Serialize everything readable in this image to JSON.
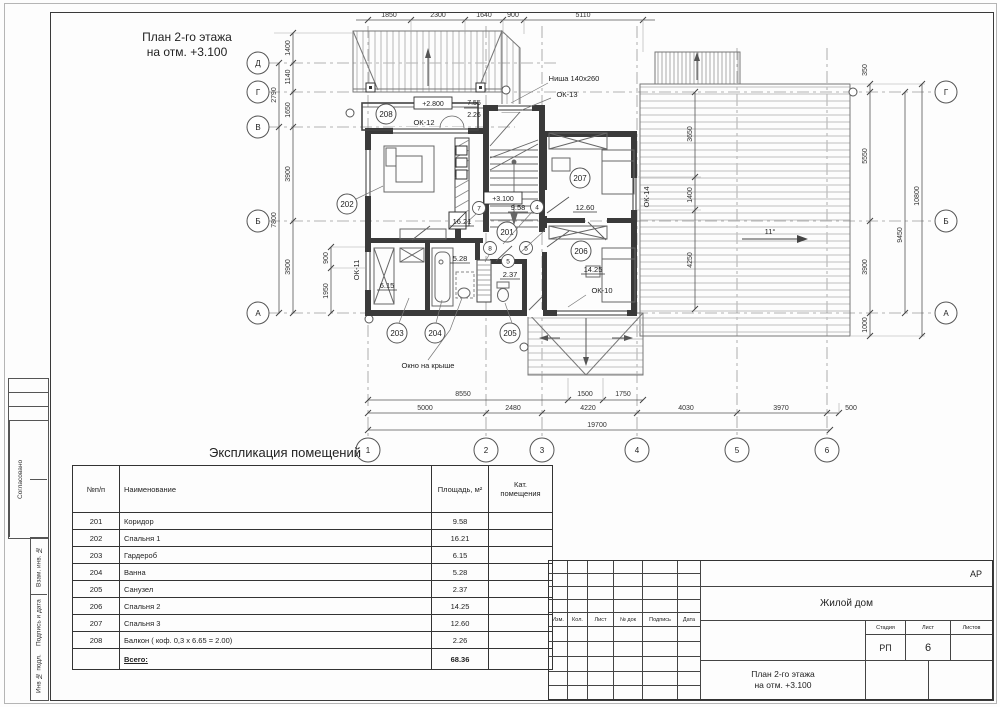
{
  "sheet": {
    "plan_title_line1": "План 2-го этажа",
    "plan_title_line2": "на отм. +3.100",
    "strip": {
      "approved": "Согласовано",
      "replace_inv": "Взам. инв. №",
      "sign_date": "Подпись и дата",
      "inv_orig": "Инв № подл."
    }
  },
  "plan": {
    "axes": {
      "left": [
        "Д",
        "Г",
        "В",
        "Б",
        "А"
      ],
      "right": [
        "Г",
        "Б",
        "А"
      ],
      "bottom": [
        "1",
        "2",
        "3",
        "4",
        "5",
        "6"
      ]
    },
    "dims": {
      "top": [
        "1850",
        "2300",
        "1640",
        "900",
        "5110"
      ],
      "left": [
        "1400",
        "1140",
        "1650",
        "3900",
        "3900",
        "2790",
        "7800",
        "900",
        "1950"
      ],
      "right": [
        "350",
        "5550",
        "3900",
        "1000",
        "9450",
        "10800",
        "3650",
        "1400",
        "4250"
      ],
      "bottom": [
        "8550",
        "1500",
        "1750",
        "5000",
        "2480",
        "4220",
        "4030",
        "3970",
        "500",
        "19700"
      ]
    },
    "levels": {
      "balcony": "+2.800",
      "floor": "+3.100"
    },
    "balcony_area": {
      "top": "7.55",
      "bottom": "2.26"
    },
    "windows": {
      "ok10": "ОК-10",
      "ok11": "ОК-11",
      "ok12": "ОК-12",
      "ok13": "ОК-13",
      "ok14": "ОК-14"
    },
    "notes": {
      "niche": "Ниша 140x260",
      "roof_window": "Окно на крыше",
      "slope": "11°"
    },
    "rooms": [
      "201",
      "202",
      "203",
      "204",
      "205",
      "206",
      "207",
      "208"
    ],
    "areas": {
      "r201": "9.58",
      "r202": "16.21",
      "r203": "6.15",
      "r204": "5.28",
      "r205": "2.37",
      "r206": "14.25",
      "r207": "12.60"
    },
    "details": [
      "7",
      "4",
      "8",
      "5",
      "5"
    ]
  },
  "table": {
    "title": "Экспликация помещений",
    "headers": {
      "num": "№п/п",
      "name": "Наименование",
      "area": "Площадь, м²",
      "cat": "Кат. помещения"
    },
    "rows": [
      {
        "num": "201",
        "name": "Коридор",
        "area": "9.58"
      },
      {
        "num": "202",
        "name": "Спальня 1",
        "area": "16.21"
      },
      {
        "num": "203",
        "name": "Гардероб",
        "area": "6.15"
      },
      {
        "num": "204",
        "name": "Ванна",
        "area": "5.28"
      },
      {
        "num": "205",
        "name": "Санузел",
        "area": "2.37"
      },
      {
        "num": "206",
        "name": "Спальня 2",
        "area": "14.25"
      },
      {
        "num": "207",
        "name": "Спальня 3",
        "area": "12.60"
      },
      {
        "num": "208",
        "name": "Балкон ( коф. 0,3 х 6.65 = 2.00)",
        "area": "2.26"
      }
    ],
    "total_label": "Всего:",
    "total_value": "68.36"
  },
  "titleblock": {
    "code": "АР",
    "project": "Жилой дом",
    "cols": [
      "Изм.",
      "Кол.",
      "Лист",
      "№ док",
      "Подпись",
      "Дата"
    ],
    "stage_label": "Стадия",
    "sheet_label": "Лист",
    "sheets_label": "Листов",
    "stage": "РП",
    "sheet_no": "6",
    "title_line1": "План 2-го этажа",
    "title_line2": "на отм. +3.100"
  }
}
